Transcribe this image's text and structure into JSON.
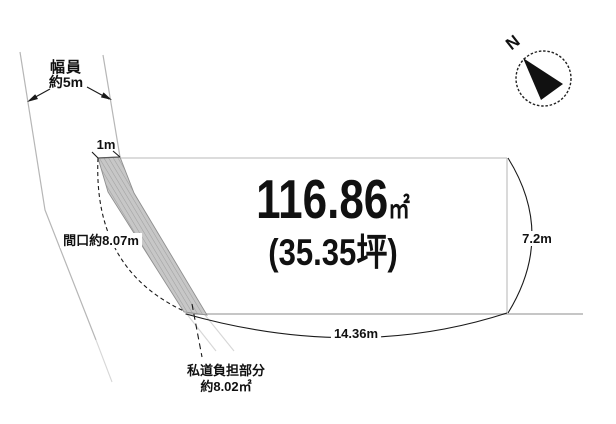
{
  "diagram": {
    "area": {
      "main_value": "116.86",
      "main_unit": "㎡",
      "tsubo": "(35.35坪)"
    },
    "labels": {
      "road_width_title": "幅員",
      "road_width_value": "約5m",
      "strip_top_width": "1m",
      "frontage": "間口約8.07m",
      "right_side_length": "7.2m",
      "bottom_side_length": "14.36m",
      "private_road_line1": "私道負担部分",
      "private_road_line2": "約8.02㎡",
      "compass_north": "N"
    },
    "colors": {
      "outline_gray": "#c6c6c6",
      "road_gray": "#b6b6b6",
      "strip_fill": "#c7c7c7",
      "strip_hatch": "#a0a0a0",
      "strip_border": "#8f8f8f",
      "dimension_black": "#1a1a1a"
    }
  }
}
